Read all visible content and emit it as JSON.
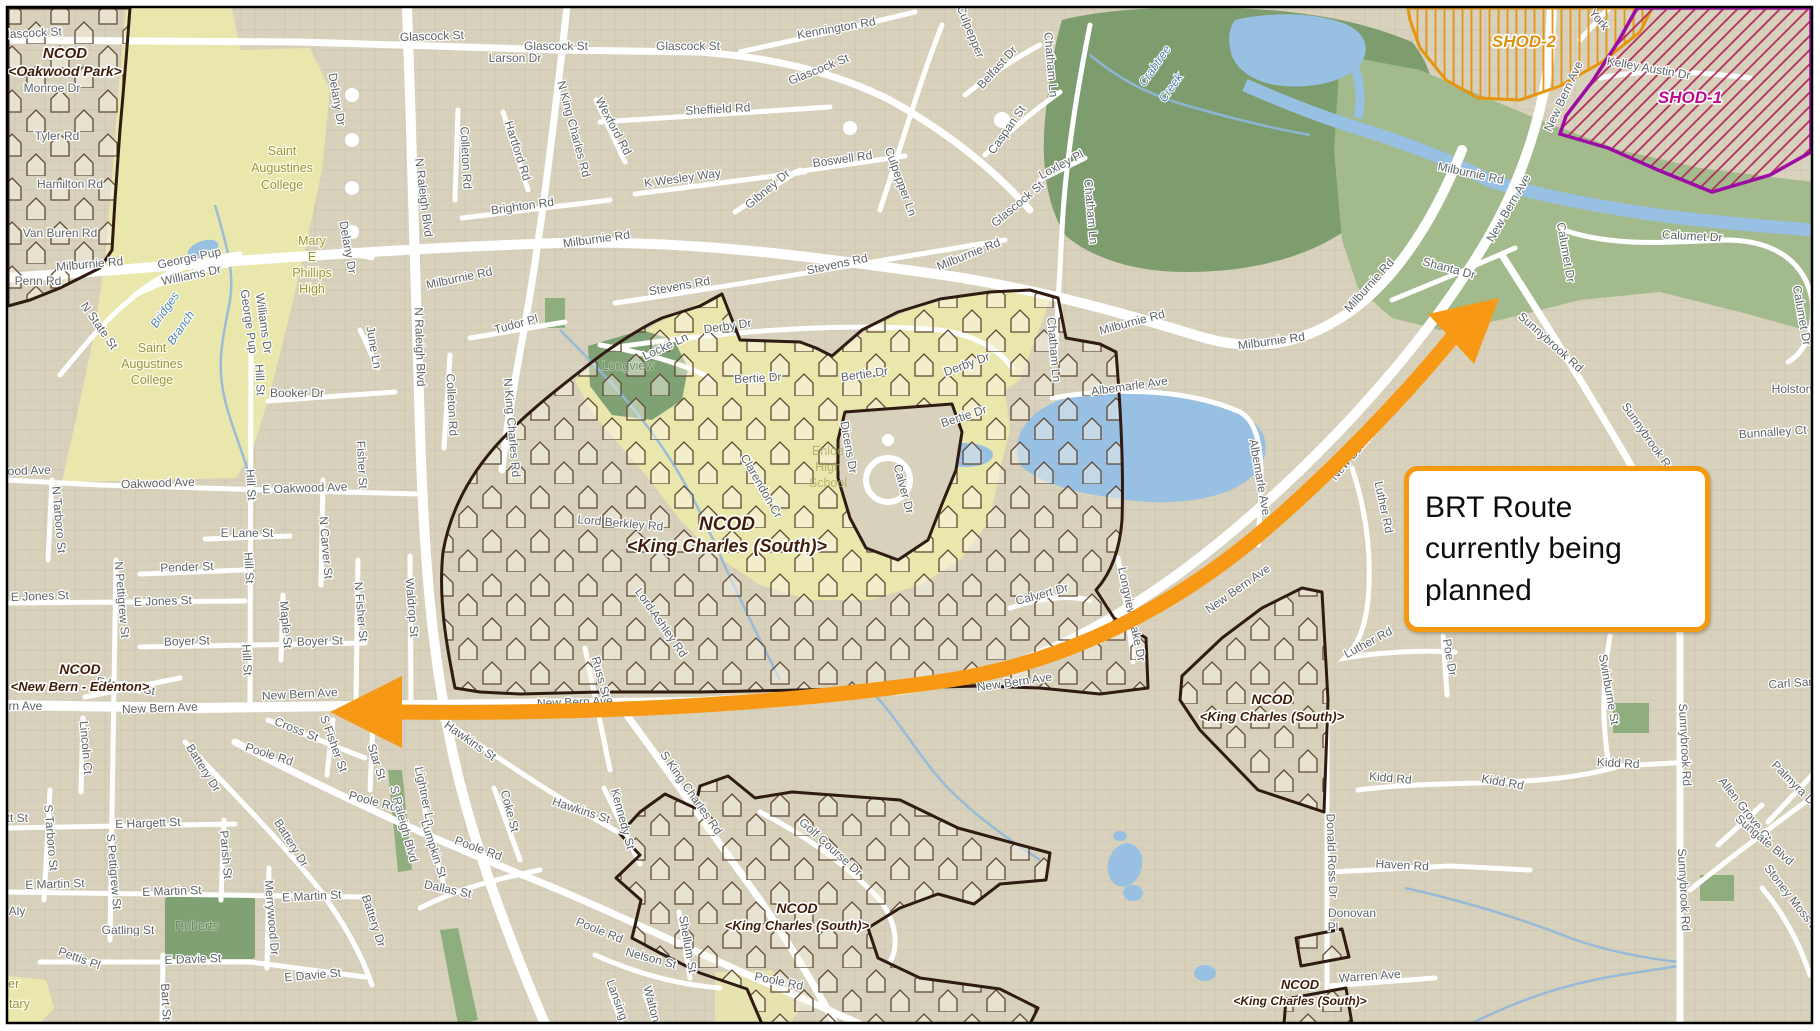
{
  "callout": {
    "text": "BRT Route currently being planned"
  },
  "colors": {
    "base_tan": "#d8d1bc",
    "campus_yellow": "#eae7ad",
    "forest_green": "#7e9d6f",
    "light_green": "#a3ba8c",
    "park_green": "#7fa173",
    "water_blue": "#98c0e2",
    "road_white": "#ffffff",
    "ncod_border": "#2f1b12",
    "arrow_orange": "#f79914",
    "callout_border": "#f49a0c",
    "shod2_orange": "#e6950e",
    "shod1_magenta": "#bb0f8f",
    "shod1_border": "#9c0ba4",
    "street_label_gray": "#5f6468"
  },
  "ncod_labels": [
    {
      "l1": "NCOD",
      "l2": "<Oakwood Park>",
      "x": 65,
      "y": 58,
      "s": 15
    },
    {
      "l1": "NCOD",
      "l2": "<King Charles (South)>",
      "x": 727,
      "y": 530,
      "s": 19
    },
    {
      "l1": "NCOD",
      "l2": "<New Bern - Edenton>",
      "x": 80,
      "y": 674,
      "s": 14
    },
    {
      "l1": "NCOD",
      "l2": "<King Charles (South)>",
      "x": 1272,
      "y": 704,
      "s": 14
    },
    {
      "l1": "NCOD",
      "l2": "<King Charles (South)>",
      "x": 797,
      "y": 913,
      "s": 14
    },
    {
      "l1": "NCOD",
      "l2": "<King Charles (South)>",
      "x": 1300,
      "y": 989,
      "s": 13
    }
  ],
  "shod_labels": [
    {
      "t": "SHOD-2",
      "x": 1524,
      "y": 47,
      "color": "#e09010"
    },
    {
      "t": "SHOD-1",
      "x": 1690,
      "y": 103,
      "color": "#c00890"
    }
  ],
  "place_labels": [
    {
      "t": "Saint",
      "x": 282,
      "y": 155,
      "cls": "campus"
    },
    {
      "t": "Augustines",
      "x": 282,
      "y": 172,
      "cls": "campus"
    },
    {
      "t": "College",
      "x": 282,
      "y": 189,
      "cls": "campus"
    },
    {
      "t": "Saint",
      "x": 152,
      "y": 352,
      "cls": "campus"
    },
    {
      "t": "Augustines",
      "x": 152,
      "y": 368,
      "cls": "campus"
    },
    {
      "t": "College",
      "x": 152,
      "y": 384,
      "cls": "campus"
    },
    {
      "t": "Mary",
      "x": 312,
      "y": 245,
      "cls": "campus"
    },
    {
      "t": "E",
      "x": 312,
      "y": 261,
      "cls": "campus"
    },
    {
      "t": "Phillips",
      "x": 312,
      "y": 277,
      "cls": "campus"
    },
    {
      "t": "High",
      "x": 312,
      "y": 293,
      "cls": "campus"
    },
    {
      "t": "Enloe",
      "x": 828,
      "y": 455,
      "cls": "campus-faint"
    },
    {
      "t": "High",
      "x": 828,
      "y": 471,
      "cls": "campus-faint"
    },
    {
      "t": "School",
      "x": 828,
      "y": 487,
      "cls": "campus-faint"
    },
    {
      "t": "Longview",
      "x": 628,
      "y": 370,
      "cls": "park"
    },
    {
      "t": "Roberts",
      "x": 197,
      "y": 930,
      "cls": "park"
    },
    {
      "t": "Crabtree",
      "x": 1158,
      "y": 68,
      "cls": "water",
      "r": -55
    },
    {
      "t": "Creek",
      "x": 1174,
      "y": 90,
      "cls": "water",
      "r": -55
    },
    {
      "t": "Bridges",
      "x": 168,
      "y": 312,
      "cls": "water",
      "r": -55
    },
    {
      "t": "Branch",
      "x": 184,
      "y": 330,
      "cls": "water",
      "r": -55
    },
    {
      "t": "ter",
      "x": 12,
      "y": 988,
      "cls": "campus"
    },
    {
      "t": "ntary",
      "x": 16,
      "y": 1008,
      "cls": "campus"
    }
  ],
  "street_labels": [
    {
      "t": "Glascock St",
      "x": 30,
      "y": 37,
      "r": -3
    },
    {
      "t": "Glascock St",
      "x": 432,
      "y": 40,
      "r": -2
    },
    {
      "t": "Larson Dr",
      "x": 515,
      "y": 62,
      "r": 0
    },
    {
      "t": "Glascock St",
      "x": 556,
      "y": 50,
      "r": 0
    },
    {
      "t": "Glascock St",
      "x": 688,
      "y": 50,
      "r": 0
    },
    {
      "t": "Kennington Rd",
      "x": 837,
      "y": 32,
      "r": -10
    },
    {
      "t": "Glascock St",
      "x": 820,
      "y": 73,
      "r": -22
    },
    {
      "t": "Sheffield Rd",
      "x": 718,
      "y": 113,
      "r": -3
    },
    {
      "t": "Boswell Rd",
      "x": 843,
      "y": 163,
      "r": -8
    },
    {
      "t": "Belfast Dr",
      "x": 1000,
      "y": 70,
      "r": -48
    },
    {
      "t": "Chatham Ln",
      "x": 1047,
      "y": 65,
      "r": 85
    },
    {
      "t": "Chatham Ln",
      "x": 1087,
      "y": 212,
      "r": 85
    },
    {
      "t": "Chatham Ln",
      "x": 1050,
      "y": 350,
      "r": 85
    },
    {
      "t": "Caspan St",
      "x": 1010,
      "y": 132,
      "r": -55
    },
    {
      "t": "Loxley Pl",
      "x": 1063,
      "y": 168,
      "r": -28
    },
    {
      "t": "Culpepper Ln",
      "x": 897,
      "y": 183,
      "r": 70
    },
    {
      "t": "Culpepper",
      "x": 967,
      "y": 33,
      "r": 68
    },
    {
      "t": "Glascock St",
      "x": 1020,
      "y": 207,
      "r": -40
    },
    {
      "t": "Milburnie Rd",
      "x": 970,
      "y": 258,
      "r": -22
    },
    {
      "t": "N King Charles Rd",
      "x": 570,
      "y": 130,
      "r": 75
    },
    {
      "t": "Colleton Rd",
      "x": 462,
      "y": 158,
      "r": 87
    },
    {
      "t": "Hartford Rd",
      "x": 514,
      "y": 152,
      "r": 72
    },
    {
      "t": "Wexford Rd",
      "x": 610,
      "y": 128,
      "r": 62
    },
    {
      "t": "K Wesley Way",
      "x": 683,
      "y": 182,
      "r": -8
    },
    {
      "t": "Gibney Dr",
      "x": 770,
      "y": 192,
      "r": -40
    },
    {
      "t": "Brighton Rd",
      "x": 523,
      "y": 210,
      "r": -8
    },
    {
      "t": "Milburnie Rd",
      "x": 597,
      "y": 243,
      "r": -8
    },
    {
      "t": "N Raleigh Blvd",
      "x": 420,
      "y": 198,
      "r": 83
    },
    {
      "t": "N Raleigh Blvd",
      "x": 416,
      "y": 347,
      "r": 88
    },
    {
      "t": "Milburnie Rd",
      "x": 460,
      "y": 282,
      "r": -12
    },
    {
      "t": "Milburnie Rd",
      "x": 90,
      "y": 268,
      "r": -5
    },
    {
      "t": "Stevens Rd",
      "x": 680,
      "y": 290,
      "r": -10
    },
    {
      "t": "Stevens Rd",
      "x": 838,
      "y": 268,
      "r": -12
    },
    {
      "t": "Derby Dr",
      "x": 728,
      "y": 330,
      "r": -8
    },
    {
      "t": "Derby Dr",
      "x": 968,
      "y": 368,
      "r": -20
    },
    {
      "t": "Tudor Pl",
      "x": 517,
      "y": 328,
      "r": -15
    },
    {
      "t": "Locke Ln",
      "x": 667,
      "y": 350,
      "r": -25
    },
    {
      "t": "June Ln",
      "x": 370,
      "y": 348,
      "r": 80
    },
    {
      "t": "Colleton Rd",
      "x": 448,
      "y": 405,
      "r": 87
    },
    {
      "t": "N King Charles Rd",
      "x": 508,
      "y": 428,
      "r": 85
    },
    {
      "t": "Fisher St",
      "x": 358,
      "y": 465,
      "r": 87
    },
    {
      "t": "Delany Dr",
      "x": 333,
      "y": 100,
      "r": 80
    },
    {
      "t": "Delany Dr",
      "x": 344,
      "y": 248,
      "r": 80
    },
    {
      "t": "Hill St",
      "x": 256,
      "y": 380,
      "r": 87
    },
    {
      "t": "Hill St",
      "x": 247,
      "y": 485,
      "r": 87
    },
    {
      "t": "Hill St",
      "x": 245,
      "y": 568,
      "r": 87
    },
    {
      "t": "Hill St",
      "x": 243,
      "y": 660,
      "r": 87
    },
    {
      "t": "Booker Dr",
      "x": 297,
      "y": 397,
      "r": 0
    },
    {
      "t": "N State St",
      "x": 96,
      "y": 328,
      "r": 55
    },
    {
      "t": "Oakwood Ave",
      "x": 158,
      "y": 487,
      "r": -2
    },
    {
      "t": "E Oakwood Ave",
      "x": 305,
      "y": 492,
      "r": -2
    },
    {
      "t": "Oakwood Ave",
      "x": 14,
      "y": 475,
      "r": -2
    },
    {
      "t": "N Tarboro St",
      "x": 55,
      "y": 520,
      "r": 85
    },
    {
      "t": "N Carver St",
      "x": 322,
      "y": 548,
      "r": 85
    },
    {
      "t": "N Fisher St",
      "x": 357,
      "y": 612,
      "r": 85
    },
    {
      "t": "E Lane St",
      "x": 247,
      "y": 537,
      "r": 0
    },
    {
      "t": "Pender St",
      "x": 187,
      "y": 571,
      "r": -2
    },
    {
      "t": "E Jones St",
      "x": 40,
      "y": 600,
      "r": -2
    },
    {
      "t": "E Jones St",
      "x": 163,
      "y": 605,
      "r": -2
    },
    {
      "t": "N Pettigrew St",
      "x": 118,
      "y": 600,
      "r": 85
    },
    {
      "t": "Boyer St",
      "x": 187,
      "y": 645,
      "r": -2
    },
    {
      "t": "Boyer St",
      "x": 320,
      "y": 645,
      "r": -2
    },
    {
      "t": "Maple St",
      "x": 282,
      "y": 625,
      "r": 85
    },
    {
      "t": "New Bern Ave",
      "x": 160,
      "y": 712,
      "r": -2
    },
    {
      "t": "New Bern Ave",
      "x": 300,
      "y": 698,
      "r": -3
    },
    {
      "t": "ern Ave",
      "x": 22,
      "y": 710,
      "r": 0
    },
    {
      "t": "Edenton St",
      "x": 125,
      "y": 690,
      "r": 10
    },
    {
      "t": "Lincoln Ct",
      "x": 82,
      "y": 748,
      "r": 85
    },
    {
      "t": "Cross St",
      "x": 295,
      "y": 733,
      "r": 22
    },
    {
      "t": "Poole Rd",
      "x": 268,
      "y": 758,
      "r": 18
    },
    {
      "t": "Poole Rd",
      "x": 372,
      "y": 805,
      "r": 15
    },
    {
      "t": "Poole Rd",
      "x": 477,
      "y": 852,
      "r": 20
    },
    {
      "t": "Poole Rd",
      "x": 598,
      "y": 934,
      "r": 22
    },
    {
      "t": "Poole Rd",
      "x": 778,
      "y": 985,
      "r": 12
    },
    {
      "t": "S Fisher St",
      "x": 330,
      "y": 745,
      "r": 70
    },
    {
      "t": "Star St",
      "x": 373,
      "y": 763,
      "r": 72
    },
    {
      "t": "Battery Dr",
      "x": 200,
      "y": 770,
      "r": 58
    },
    {
      "t": "Battery Dr",
      "x": 288,
      "y": 845,
      "r": 58
    },
    {
      "t": "Battery Dr",
      "x": 370,
      "y": 922,
      "r": 72
    },
    {
      "t": "E Hargett St",
      "x": 148,
      "y": 827,
      "r": -2
    },
    {
      "t": "ett St",
      "x": 14,
      "y": 822,
      "r": 0
    },
    {
      "t": "S Tarboro St",
      "x": 47,
      "y": 838,
      "r": 85
    },
    {
      "t": "E Martin St",
      "x": 55,
      "y": 888,
      "r": -2
    },
    {
      "t": "E Martin St",
      "x": 172,
      "y": 895,
      "r": -2
    },
    {
      "t": "E Martin St",
      "x": 312,
      "y": 900,
      "r": -3
    },
    {
      "t": "t Aly",
      "x": 14,
      "y": 915,
      "r": 0
    },
    {
      "t": "S Pettigrew St",
      "x": 110,
      "y": 872,
      "r": 85
    },
    {
      "t": "Gatling St",
      "x": 128,
      "y": 934,
      "r": 0
    },
    {
      "t": "Parish St",
      "x": 222,
      "y": 855,
      "r": 85
    },
    {
      "t": "Pettis Pl",
      "x": 78,
      "y": 962,
      "r": 20
    },
    {
      "t": "E Davie St",
      "x": 193,
      "y": 963,
      "r": -2
    },
    {
      "t": "E Davie St",
      "x": 313,
      "y": 979,
      "r": -5
    },
    {
      "t": "Merrywood Dr",
      "x": 268,
      "y": 918,
      "r": 85
    },
    {
      "t": "Bart St",
      "x": 162,
      "y": 1002,
      "r": 87
    },
    {
      "t": "S Raleigh Blvd",
      "x": 400,
      "y": 825,
      "r": 75
    },
    {
      "t": "Lightner Ln",
      "x": 421,
      "y": 797,
      "r": 78
    },
    {
      "t": "Lumpkin St",
      "x": 430,
      "y": 850,
      "r": 72
    },
    {
      "t": "Dallas St",
      "x": 447,
      "y": 893,
      "r": 12
    },
    {
      "t": "Coke St",
      "x": 506,
      "y": 812,
      "r": 75
    },
    {
      "t": "Hawkins St",
      "x": 468,
      "y": 744,
      "r": 35
    },
    {
      "t": "Hawkins St",
      "x": 580,
      "y": 814,
      "r": 18
    },
    {
      "t": "Kennedy St",
      "x": 619,
      "y": 820,
      "r": 75
    },
    {
      "t": "Russ St",
      "x": 597,
      "y": 678,
      "r": 75
    },
    {
      "t": "Waldrop St",
      "x": 408,
      "y": 608,
      "r": 85
    },
    {
      "t": "S King Charles Rd",
      "x": 688,
      "y": 795,
      "r": 55
    },
    {
      "t": "Shellum St",
      "x": 684,
      "y": 945,
      "r": 80
    },
    {
      "t": "Nelson St",
      "x": 650,
      "y": 962,
      "r": 15
    },
    {
      "t": "Lansing St",
      "x": 616,
      "y": 1008,
      "r": 70
    },
    {
      "t": "Walton St",
      "x": 650,
      "y": 1012,
      "r": 75
    },
    {
      "t": "Golf Course Dr",
      "x": 828,
      "y": 850,
      "r": 42
    },
    {
      "t": "New Bern Ave",
      "x": 575,
      "y": 706,
      "r": -2
    },
    {
      "t": "New Bern Ave",
      "x": 720,
      "y": 707,
      "r": -2
    },
    {
      "t": "New Bern Ave",
      "x": 868,
      "y": 696,
      "r": -5
    },
    {
      "t": "New Bern Ave",
      "x": 1015,
      "y": 686,
      "r": -8
    },
    {
      "t": "New Bern Ave",
      "x": 1240,
      "y": 592,
      "r": -35
    },
    {
      "t": "New Bern Ave",
      "x": 1360,
      "y": 452,
      "r": -50
    },
    {
      "t": "New Bern Ave",
      "x": 1567,
      "y": 98,
      "r": -65
    },
    {
      "t": "New Bern Ave",
      "x": 1512,
      "y": 210,
      "r": -60
    },
    {
      "t": "Lord Berkley Rd",
      "x": 620,
      "y": 527,
      "r": 5
    },
    {
      "t": "Lord Ashley Rd",
      "x": 658,
      "y": 625,
      "r": 55
    },
    {
      "t": "Clarendon Cr",
      "x": 758,
      "y": 488,
      "r": 60
    },
    {
      "t": "Bertie Dr",
      "x": 758,
      "y": 382,
      "r": -3
    },
    {
      "t": "Bertie Dr",
      "x": 865,
      "y": 378,
      "r": -8
    },
    {
      "t": "Bertie Dr",
      "x": 965,
      "y": 420,
      "r": -18
    },
    {
      "t": "Dicens Dr",
      "x": 845,
      "y": 448,
      "r": 80
    },
    {
      "t": "Calver Dr",
      "x": 900,
      "y": 490,
      "r": 75
    },
    {
      "t": "Calvert Dr",
      "x": 1043,
      "y": 598,
      "r": -15
    },
    {
      "t": "Albemarle Ave",
      "x": 1130,
      "y": 390,
      "r": -8
    },
    {
      "t": "Albemarle Ave",
      "x": 1256,
      "y": 478,
      "r": 80
    },
    {
      "t": "Milburnie Rd",
      "x": 1133,
      "y": 326,
      "r": -15
    },
    {
      "t": "Milburnie Rd",
      "x": 1272,
      "y": 345,
      "r": -8
    },
    {
      "t": "Milburnie Rd",
      "x": 1372,
      "y": 288,
      "r": -48
    },
    {
      "t": "Shanta Dr",
      "x": 1448,
      "y": 272,
      "r": 15
    },
    {
      "t": "Luther Rd",
      "x": 1380,
      "y": 508,
      "r": 78
    },
    {
      "t": "Luther Rd",
      "x": 1370,
      "y": 646,
      "r": -28
    },
    {
      "t": "Longview Lake Dr",
      "x": 1128,
      "y": 615,
      "r": 78
    },
    {
      "t": "Poe Dr",
      "x": 1446,
      "y": 658,
      "r": 80
    },
    {
      "t": "Swinburne St",
      "x": 1605,
      "y": 690,
      "r": 80
    },
    {
      "t": "Sunnybrook Rd",
      "x": 1548,
      "y": 345,
      "r": 42
    },
    {
      "t": "Sunnybrook Rd",
      "x": 1645,
      "y": 440,
      "r": 55
    },
    {
      "t": "Sunnybrook Rd",
      "x": 1681,
      "y": 745,
      "r": 87
    },
    {
      "t": "Sunnybrook Rd",
      "x": 1680,
      "y": 890,
      "r": 87
    },
    {
      "t": "Kidd Rd",
      "x": 1390,
      "y": 782,
      "r": 5
    },
    {
      "t": "Kidd Rd",
      "x": 1502,
      "y": 786,
      "r": 10
    },
    {
      "t": "Kidd Rd",
      "x": 1618,
      "y": 767,
      "r": 3
    },
    {
      "t": "Haven Rd",
      "x": 1402,
      "y": 869,
      "r": 3
    },
    {
      "t": "Donald Ross Dr",
      "x": 1328,
      "y": 856,
      "r": 88
    },
    {
      "t": "Warren Ave",
      "x": 1370,
      "y": 980,
      "r": -4
    },
    {
      "t": "Carl San",
      "x": 1792,
      "y": 687,
      "r": -4
    },
    {
      "t": "Holston",
      "x": 1792,
      "y": 393,
      "r": 0
    },
    {
      "t": "Bunnalley Ct",
      "x": 1773,
      "y": 436,
      "r": -4
    },
    {
      "t": "Calumet Dr",
      "x": 1562,
      "y": 253,
      "r": 80
    },
    {
      "t": "Calumet Dr",
      "x": 1692,
      "y": 240,
      "r": 3
    },
    {
      "t": "Calumet Dr",
      "x": 1798,
      "y": 316,
      "r": 80
    },
    {
      "t": "Allen Grove Ct",
      "x": 1742,
      "y": 812,
      "r": 52
    },
    {
      "t": "Palmyra Dr",
      "x": 1792,
      "y": 787,
      "r": 45
    },
    {
      "t": "Sungate Blvd",
      "x": 1762,
      "y": 843,
      "r": 40
    },
    {
      "t": "Stoney Moss Dr",
      "x": 1790,
      "y": 902,
      "r": 52
    },
    {
      "t": "Kelley Austin Dr",
      "x": 1648,
      "y": 72,
      "r": 10
    },
    {
      "t": "York",
      "x": 1596,
      "y": 22,
      "r": 50
    },
    {
      "t": "Milburnie Rd",
      "x": 1470,
      "y": 177,
      "r": 12
    },
    {
      "t": "Donovan",
      "x": 1352,
      "y": 917,
      "r": 0
    },
    {
      "t": "Pl",
      "x": 1333,
      "y": 931,
      "r": 0
    },
    {
      "t": "George Pup",
      "x": 190,
      "y": 262,
      "r": -12
    },
    {
      "t": "Williams Dr",
      "x": 192,
      "y": 279,
      "r": -12
    },
    {
      "t": "George Pup",
      "x": 245,
      "y": 322,
      "r": 82
    },
    {
      "t": "Williams Dr",
      "x": 260,
      "y": 324,
      "r": 82
    },
    {
      "t": "Tyler Rd",
      "x": 57,
      "y": 140,
      "r": 0
    },
    {
      "t": "Hamilton Rd",
      "x": 70,
      "y": 188,
      "r": 0
    },
    {
      "t": "Van Buren Rd",
      "x": 60,
      "y": 237,
      "r": 0
    },
    {
      "t": "Penn Rd",
      "x": 38,
      "y": 285,
      "r": 0
    },
    {
      "t": "Monroe Dr",
      "x": 52,
      "y": 92,
      "r": 0
    }
  ]
}
